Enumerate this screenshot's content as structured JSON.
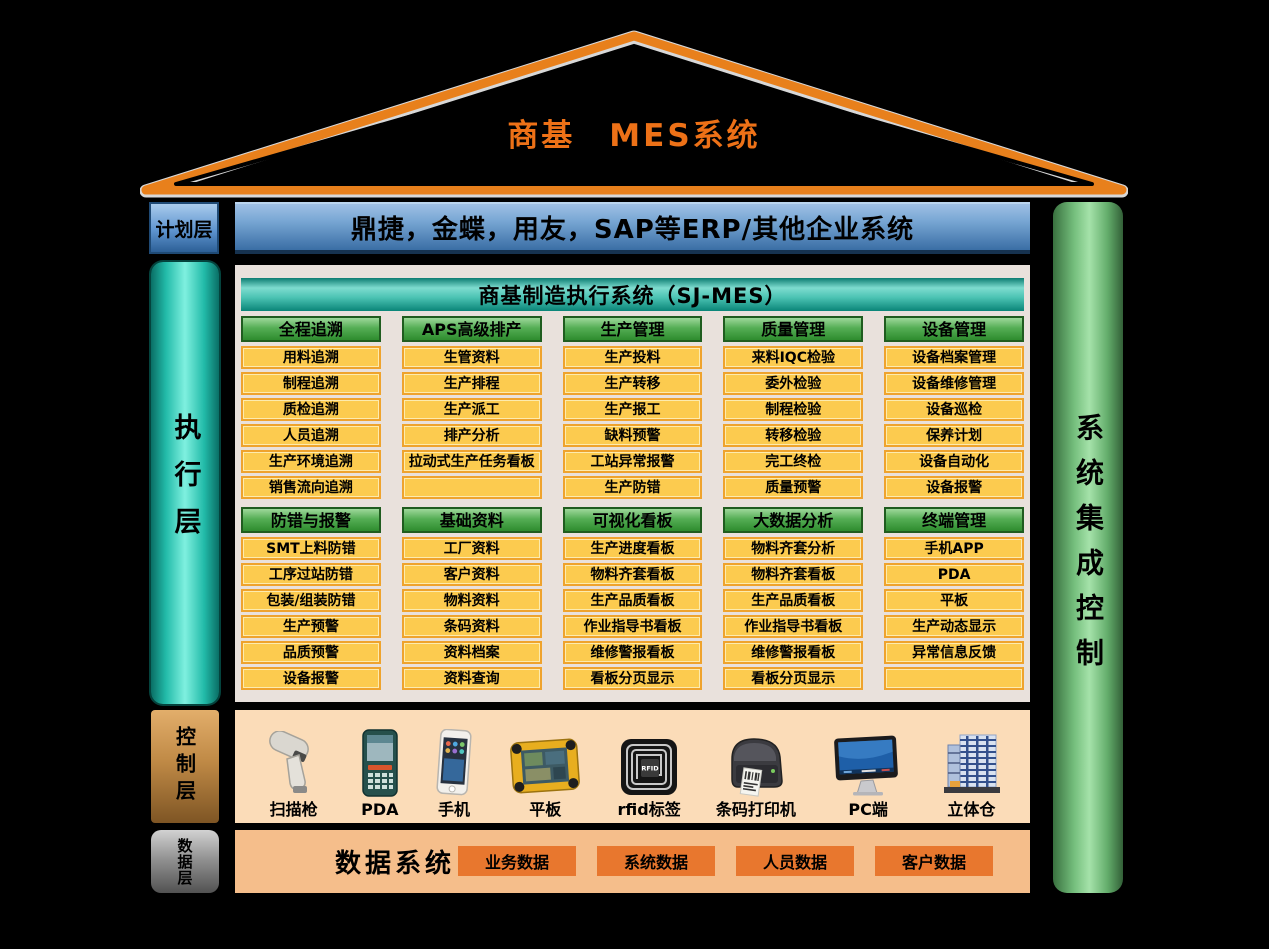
{
  "title": "商基　MES系统",
  "layers": {
    "plan_label": "计划层",
    "execution_label": "执行层",
    "control_label": "控制层",
    "data_label": "数据层"
  },
  "right_pillar_label": "系统集成控制",
  "erp_bar_text": "鼎捷，金蝶，用友，SAP等ERP/其他企业系统",
  "mes_panel": {
    "header": "商基制造执行系统（SJ-MES）",
    "rows": [
      [
        {
          "title": "全程追溯",
          "items": [
            "用料追溯",
            "制程追溯",
            "质检追溯",
            "人员追溯",
            "生产环境追溯",
            "销售流向追溯"
          ]
        },
        {
          "title": "APS高级排产",
          "items": [
            "生管资料",
            "生产排程",
            "生产派工",
            "排产分析",
            "拉动式生产任务看板",
            ""
          ]
        },
        {
          "title": "生产管理",
          "items": [
            "生产投料",
            "生产转移",
            "生产报工",
            "缺料预警",
            "工站异常报警",
            "生产防错"
          ]
        },
        {
          "title": "质量管理",
          "items": [
            "来料IQC检验",
            "委外检验",
            "制程检验",
            "转移检验",
            "完工终检",
            "质量预警"
          ]
        },
        {
          "title": "设备管理",
          "items": [
            "设备档案管理",
            "设备维修管理",
            "设备巡检",
            "保养计划",
            "设备自动化",
            "设备报警"
          ]
        }
      ],
      [
        {
          "title": "防错与报警",
          "items": [
            "SMT上料防错",
            "工序过站防错",
            "包装/组装防错",
            "生产预警",
            "品质预警",
            "设备报警"
          ]
        },
        {
          "title": "基础资料",
          "items": [
            "工厂资料",
            "客户资料",
            "物料资料",
            "条码资料",
            "资料档案",
            "资料查询"
          ]
        },
        {
          "title": "可视化看板",
          "items": [
            "生产进度看板",
            "物料齐套看板",
            "生产品质看板",
            "作业指导书看板",
            "维修警报看板",
            "看板分页显示"
          ]
        },
        {
          "title": "大数据分析",
          "items": [
            "物料齐套分析",
            "物料齐套看板",
            "生产品质看板",
            "作业指导书看板",
            "维修警报看板",
            "看板分页显示"
          ]
        },
        {
          "title": "终端管理",
          "items": [
            "手机APP",
            "PDA",
            "平板",
            "生产动态显示",
            "异常信息反馈",
            ""
          ]
        }
      ]
    ]
  },
  "control_bar": {
    "devices": [
      {
        "icon": "barcode-scanner-icon",
        "label": "扫描枪"
      },
      {
        "icon": "pda-icon",
        "label": "PDA"
      },
      {
        "icon": "phone-icon",
        "label": "手机"
      },
      {
        "icon": "tablet-icon",
        "label": "平板"
      },
      {
        "icon": "rfid-tag-icon",
        "label": "rfid标签"
      },
      {
        "icon": "barcode-printer-icon",
        "label": "条码打印机"
      },
      {
        "icon": "pc-icon",
        "label": "PC端"
      },
      {
        "icon": "warehouse-icon",
        "label": "立体仓"
      }
    ],
    "rfid_chip_text": "RFID"
  },
  "data_bar": {
    "title": "数据系统",
    "buttons": [
      "业务数据",
      "系统数据",
      "人员数据",
      "客户数据"
    ]
  },
  "colors": {
    "background": "#000000",
    "roof_orange": "#E8801C",
    "title_orange": "#ED7117",
    "erp_blue_top": "#9FC0E4",
    "erp_blue_bottom": "#3A6EA5",
    "exec_teal": "#22BBA9",
    "pillar_green": "#74BE7C",
    "panel_gray": "#E9E1DC",
    "header_teal": "#4AC2B2",
    "module_green": "#55AE55",
    "item_yellow": "#FCCB4F",
    "item_border": "#EFA32D",
    "control_peach": "#FBDCB8",
    "control_brown": "#C08A46",
    "data_orange_bar": "#F5BE8B",
    "data_button_orange": "#E8772E",
    "data_gray": "#8F8F8F"
  }
}
